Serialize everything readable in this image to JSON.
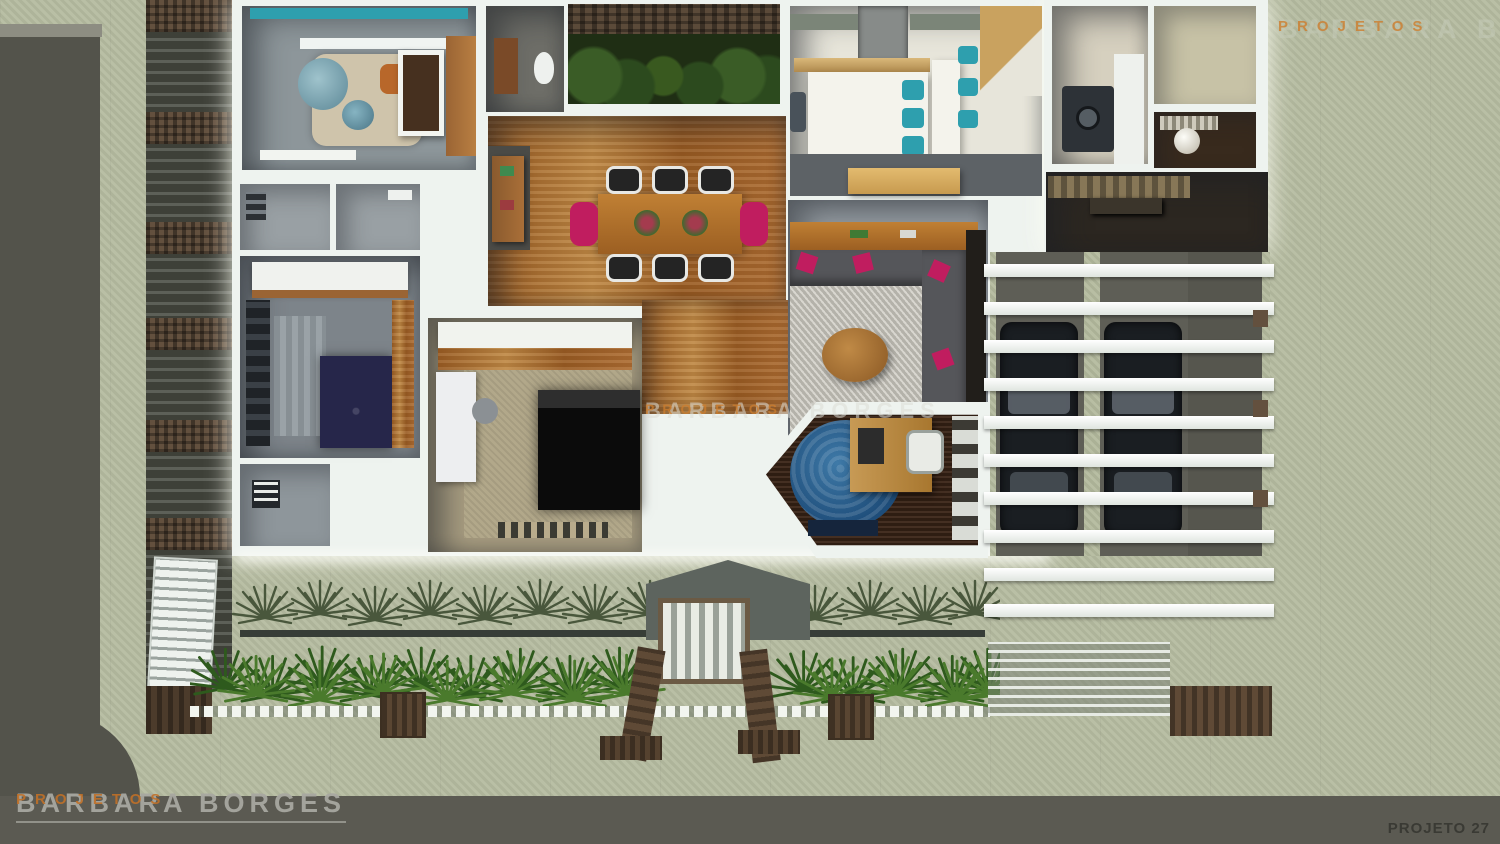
{
  "watermarks": {
    "top_right": {
      "brand": "BARBARA BORGES",
      "sub": "PROJETOS"
    },
    "center": {
      "brand": "BARBARA BORGES",
      "sub": "PROJETOS"
    },
    "bottom_left": {
      "brand": "BARBARA BORGES",
      "sub": "PROJETOS"
    },
    "bottom_right_label": "PROJETO 27"
  },
  "colors": {
    "ground": "#b6bca1",
    "street": "#53534b",
    "bottom_band": "#5b5a52",
    "wall_white": "#eef3ef",
    "wood_light": "#c08a46",
    "teal": "#2e9fae",
    "magenta": "#c01d5f",
    "sofa_gray": "#55565a",
    "rug_gray": "#cbc8bf",
    "carpet_beige": "#b2a88a",
    "navy_bed": "#26264a",
    "office_rug_blue": "#1e4d7a",
    "plant_dark": "#49573c",
    "plant_green": "#2e5a1d",
    "plant_bright": "#4a7a2c",
    "brick": "#63503e",
    "car_black": "#1a1e22",
    "accent_orange": "#c07430"
  },
  "scene": {
    "type": "3d-top-view-floor-plan-render",
    "rooms": [
      "nursery",
      "bathroom",
      "winter-garden",
      "kitchen",
      "laundry",
      "storage-room",
      "porch",
      "entry-hall",
      "dining-room",
      "living-room",
      "home-office",
      "master-bedroom",
      "bedroom",
      "closet",
      "bathroom-2",
      "bathroom-3",
      "garage-pergola",
      "front-garden",
      "entry-gate"
    ]
  }
}
